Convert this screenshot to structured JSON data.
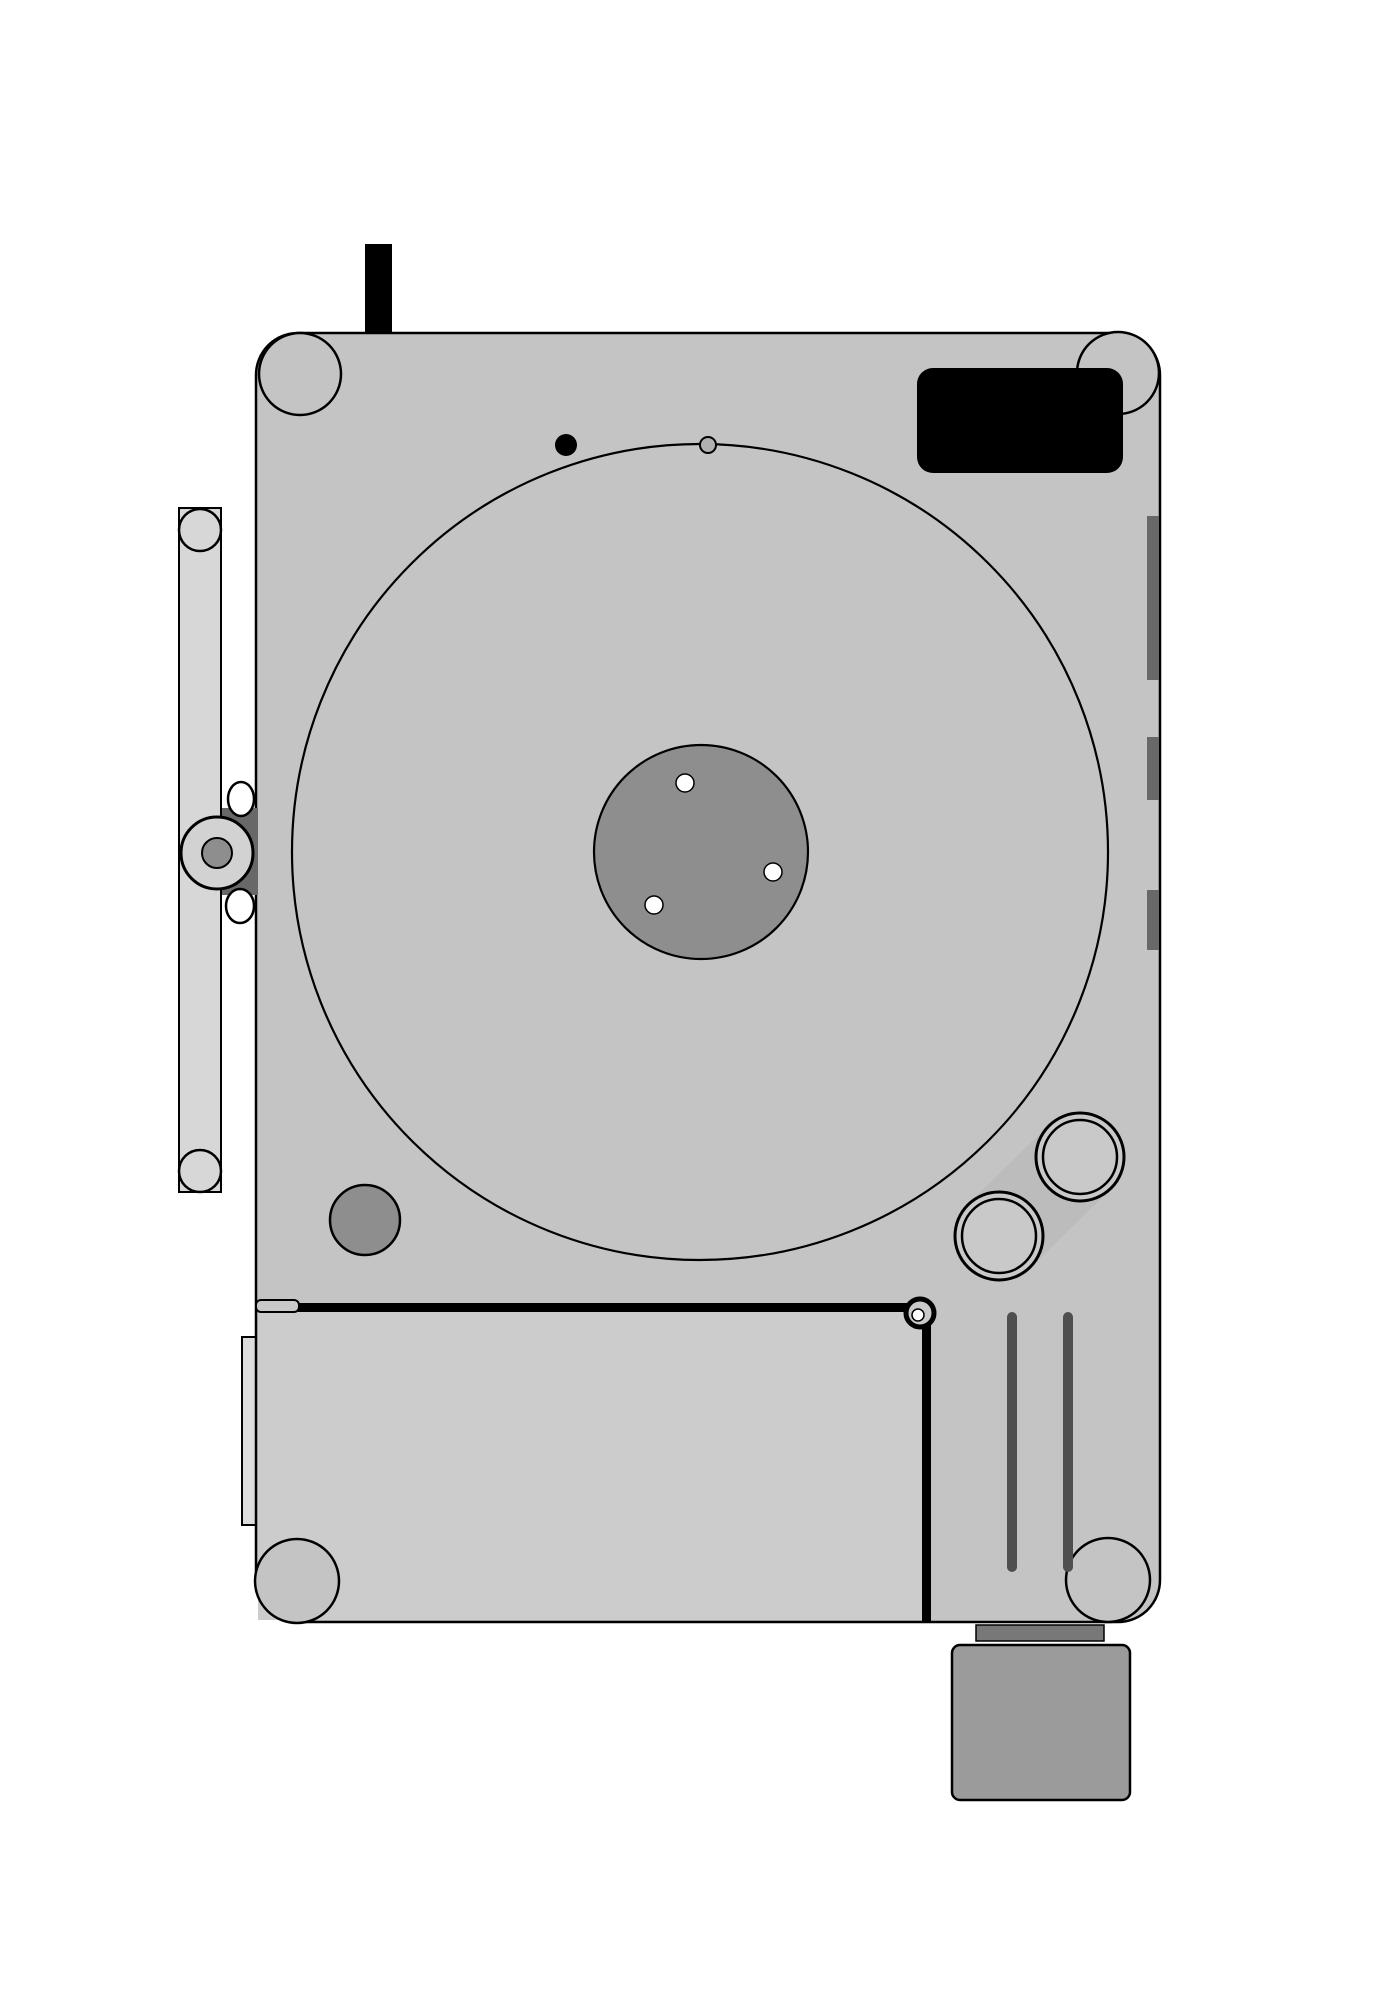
{
  "canvas": {
    "width": 1400,
    "height": 2004,
    "background": "#ffffff",
    "ink": "#000000"
  },
  "colors": {
    "body": "#c4c4c4",
    "board": "#cccccc",
    "rail": "#d7d7d7",
    "notch": "#dcdcdc",
    "pivot": "#d2d2d2",
    "mid": "#8e8e8e",
    "dark": "#686868",
    "strip": "#4f4f4f",
    "motor": "#9b9b9b",
    "motorbar": "#787878",
    "capsule": "#bcbcbc",
    "ringfill": "#c9c9c9",
    "graydot": "#b0b0b0",
    "black": "#000000",
    "white": "#ffffff"
  },
  "drawing": {
    "under_shapes": [
      {
        "t": "rect",
        "name": "side-notch",
        "x": 242,
        "y": 1337,
        "w": 17,
        "h": 188,
        "f": "notch",
        "sc": "black",
        "s": 2
      },
      {
        "t": "rect",
        "name": "plinth-body",
        "x": 256,
        "y": 333,
        "w": 904,
        "h": 1289,
        "rx": 42,
        "f": "body",
        "sc": "black",
        "s": 2.5
      },
      {
        "t": "rect",
        "name": "lower-left-board",
        "x": 258,
        "y": 1312,
        "w": 664,
        "h": 308,
        "f": "board"
      },
      {
        "t": "circle",
        "name": "corner-post-top-left",
        "cx": 300,
        "cy": 374,
        "r": 41,
        "f": "body",
        "sc": "black",
        "s": 2.5
      },
      {
        "t": "circle",
        "name": "corner-post-top-right",
        "cx": 1118,
        "cy": 373,
        "r": 41,
        "f": "body",
        "sc": "black",
        "s": 2.5
      },
      {
        "t": "circle",
        "name": "corner-post-bottom-left",
        "cx": 297,
        "cy": 1581,
        "r": 42,
        "f": "body",
        "sc": "black",
        "s": 2.5
      },
      {
        "t": "circle",
        "name": "corner-post-bottom-right",
        "cx": 1108,
        "cy": 1580,
        "r": 42,
        "f": "body",
        "sc": "black",
        "s": 2.5
      },
      {
        "t": "rect",
        "name": "hinge-rail",
        "x": 179,
        "y": 508,
        "w": 42,
        "h": 684,
        "f": "rail",
        "sc": "black",
        "s": 2
      },
      {
        "t": "circle",
        "name": "hinge-knob-top",
        "cx": 200,
        "cy": 530,
        "r": 21,
        "f": "rail",
        "sc": "black",
        "s": 2.5
      },
      {
        "t": "circle",
        "name": "hinge-knob-bottom",
        "cx": 200,
        "cy": 1171,
        "r": 21,
        "f": "rail",
        "sc": "black",
        "s": 2.5
      },
      {
        "t": "rect",
        "name": "pivot-cam-wedge",
        "x": 222,
        "y": 808,
        "w": 36,
        "h": 87,
        "f": "dark"
      },
      {
        "t": "circle",
        "name": "lid-pivot-outer",
        "cx": 217,
        "cy": 853,
        "r": 36,
        "f": "pivot",
        "sc": "black",
        "s": 3
      },
      {
        "t": "circle",
        "name": "lid-pivot-inner",
        "cx": 217,
        "cy": 853,
        "r": 15,
        "f": "mid",
        "sc": "black",
        "s": 2
      },
      {
        "t": "ellipse",
        "name": "pivot-roller-top",
        "cx": 241,
        "cy": 799,
        "rx": 13,
        "ry": 17,
        "f": "white",
        "sc": "black",
        "s": 2.5
      },
      {
        "t": "ellipse",
        "name": "pivot-roller-bottom",
        "cx": 240,
        "cy": 906,
        "rx": 14,
        "ry": 17,
        "f": "white",
        "sc": "black",
        "s": 2.5
      },
      {
        "t": "circle",
        "name": "platter-outline",
        "cx": 700,
        "cy": 852,
        "r": 408,
        "f": "none",
        "sc": "black",
        "s": 2.2
      },
      {
        "t": "circle",
        "name": "platter-hub",
        "cx": 701,
        "cy": 852,
        "r": 107,
        "f": "mid",
        "sc": "black",
        "s": 2.2
      },
      {
        "t": "circle",
        "name": "hub-hole-1",
        "cx": 685,
        "cy": 783,
        "r": 9,
        "f": "white",
        "sc": "black",
        "s": 1.5
      },
      {
        "t": "circle",
        "name": "hub-hole-2",
        "cx": 773,
        "cy": 872,
        "r": 9,
        "f": "white",
        "sc": "black",
        "s": 1.5
      },
      {
        "t": "circle",
        "name": "hub-hole-3",
        "cx": 654,
        "cy": 905,
        "r": 9,
        "f": "white",
        "sc": "black",
        "s": 1.5
      },
      {
        "t": "circle",
        "name": "power-dot",
        "cx": 566,
        "cy": 445,
        "r": 11,
        "f": "black"
      },
      {
        "t": "circle",
        "name": "pilot-dot",
        "cx": 708,
        "cy": 445,
        "r": 8,
        "f": "graydot",
        "sc": "black",
        "s": 2
      },
      {
        "t": "circle",
        "name": "speed-knob",
        "cx": 365,
        "cy": 1220,
        "r": 35,
        "f": "mid",
        "sc": "black",
        "s": 2.5
      },
      {
        "t": "poly",
        "name": "tonearm-base-capsule",
        "pts": "968,1204 1049,1125 1111,1189 1030,1268",
        "f": "capsule"
      },
      {
        "t": "circle",
        "name": "arm-bearing-upper-outer",
        "cx": 1080,
        "cy": 1157,
        "r": 44,
        "f": "ringfill",
        "sc": "black",
        "s": 3
      },
      {
        "t": "circle",
        "name": "arm-bearing-upper-inner",
        "cx": 1080,
        "cy": 1157,
        "r": 37,
        "f": "none",
        "sc": "black",
        "s": 2.5
      },
      {
        "t": "circle",
        "name": "arm-bearing-lower-outer",
        "cx": 999,
        "cy": 1236,
        "r": 44,
        "f": "ringfill",
        "sc": "black",
        "s": 3
      },
      {
        "t": "circle",
        "name": "arm-bearing-lower-inner",
        "cx": 999,
        "cy": 1236,
        "r": 37,
        "f": "none",
        "sc": "black",
        "s": 2.5
      },
      {
        "t": "rect",
        "name": "control-pad",
        "x": 917,
        "y": 368,
        "w": 206,
        "h": 105,
        "rx": 16,
        "f": "black"
      },
      {
        "t": "rect",
        "name": "edge-mark-1",
        "x": 1147,
        "y": 516,
        "w": 12,
        "h": 164,
        "f": "dark"
      },
      {
        "t": "rect",
        "name": "edge-mark-2",
        "x": 1147,
        "y": 737,
        "w": 12,
        "h": 63,
        "f": "dark"
      },
      {
        "t": "rect",
        "name": "edge-mark-3",
        "x": 1147,
        "y": 890,
        "w": 12,
        "h": 60,
        "f": "dark"
      },
      {
        "t": "rect",
        "name": "motor-collar",
        "x": 976,
        "y": 1625,
        "w": 128,
        "h": 16,
        "f": "motorbar",
        "sc": "black",
        "s": 1.5
      },
      {
        "t": "rect",
        "name": "motor-block",
        "x": 952,
        "y": 1645,
        "w": 178,
        "h": 155,
        "rx": 8,
        "f": "motor",
        "sc": "black",
        "s": 2.5
      }
    ],
    "hlines": [
      [
        333,
        0,
        1400,
        2.5
      ],
      [
        366,
        0,
        1400,
        2
      ],
      [
        443,
        0,
        1400,
        2
      ],
      [
        475,
        0,
        1400,
        2
      ],
      [
        503,
        0,
        1400,
        1.8
      ],
      [
        511,
        0,
        1400,
        1.8
      ],
      [
        680,
        0,
        1400,
        2
      ],
      [
        688,
        0,
        1400,
        2
      ],
      [
        735,
        0,
        1400,
        2
      ],
      [
        742,
        0,
        1400,
        1.6
      ],
      [
        808,
        0,
        1400,
        2
      ],
      [
        890,
        0,
        1400,
        2
      ],
      [
        897,
        0,
        1400,
        1.6
      ],
      [
        960,
        0,
        1400,
        2
      ],
      [
        966,
        0,
        1400,
        1.6
      ],
      [
        1192,
        0,
        1400,
        2.5
      ],
      [
        1263,
        0,
        1400,
        2
      ],
      [
        1292,
        0,
        1400,
        1.8
      ],
      [
        1298,
        0,
        1400,
        1.8
      ],
      [
        1307,
        0,
        1400,
        1.6
      ],
      [
        1338,
        500,
        1400,
        1.8
      ],
      [
        1347,
        500,
        1400,
        1.8
      ],
      [
        1622,
        0,
        1400,
        2.5
      ],
      [
        1642,
        0,
        1400,
        1.8
      ],
      [
        1648,
        0,
        1400,
        1.8
      ],
      [
        1800,
        690,
        1400,
        2
      ],
      [
        1806,
        690,
        1400,
        2
      ]
    ],
    "vlines": [
      [
        141,
        330,
        1195,
        1.8
      ],
      [
        178,
        0,
        2004,
        2
      ],
      [
        221,
        0,
        2004,
        2
      ],
      [
        258,
        0,
        2004,
        1.8
      ],
      [
        367,
        0,
        2004,
        2
      ],
      [
        394,
        0,
        2004,
        2
      ],
      [
        484,
        0,
        2004,
        2
      ],
      [
        700,
        0,
        2004,
        2
      ],
      [
        927,
        1622,
        2004,
        1.8
      ],
      [
        937,
        66,
        2004,
        1.8
      ],
      [
        945,
        66,
        2004,
        1.8
      ],
      [
        1008,
        66,
        2004,
        1.8
      ],
      [
        1017,
        66,
        2004,
        1.8
      ],
      [
        1063,
        66,
        2004,
        1.8
      ],
      [
        1072,
        66,
        2004,
        1.8
      ],
      [
        1128,
        66,
        1806,
        1.8
      ],
      [
        1137,
        66,
        1806,
        1.8
      ],
      [
        1149,
        66,
        1622,
        1.8
      ],
      [
        1160,
        0,
        2004,
        2.2
      ],
      [
        1172,
        66,
        2004,
        1.8
      ]
    ],
    "diagonals": [
      {
        "name": "platter-tangent-diagonal",
        "x1": 927,
        "y1": 1200,
        "x2": 1072,
        "y2": 1055,
        "w": 2
      },
      {
        "name": "capsule-tangent-upper",
        "x1": 940,
        "y1": 1232,
        "x2": 1085,
        "y2": 1087,
        "w": 2.5
      },
      {
        "name": "capsule-tangent-lower",
        "x1": 1030,
        "y1": 1268,
        "x2": 1111,
        "y2": 1189,
        "w": 2.5
      }
    ],
    "over_shapes": [
      {
        "t": "rect",
        "name": "belt-strip-left",
        "x": 1007,
        "y": 1312,
        "w": 10,
        "h": 260,
        "rx": 5,
        "f": "strip"
      },
      {
        "t": "rect",
        "name": "belt-strip-right",
        "x": 1063,
        "y": 1312,
        "w": 10,
        "h": 260,
        "rx": 5,
        "f": "strip"
      },
      {
        "t": "rect",
        "name": "tonearm-counterweight",
        "x": 256,
        "y": 1300,
        "w": 43,
        "h": 12,
        "rx": 5,
        "f": "ringfill",
        "sc": "black",
        "s": 2
      },
      {
        "t": "rect",
        "name": "tonearm-tube",
        "x": 298,
        "y": 1303,
        "w": 622,
        "h": 9,
        "f": "black"
      },
      {
        "t": "rect",
        "name": "board-divider-bar",
        "x": 922,
        "y": 1313,
        "w": 9,
        "h": 309,
        "f": "black"
      },
      {
        "t": "circle",
        "name": "tonearm-pivot-ring",
        "cx": 920,
        "cy": 1313,
        "r": 14,
        "f": "ringfill",
        "sc": "black",
        "s": 5
      },
      {
        "t": "circle",
        "name": "tonearm-pivot-hole",
        "cx": 918,
        "cy": 1315,
        "r": 6,
        "f": "white",
        "sc": "black",
        "s": 1.5
      },
      {
        "t": "rect",
        "name": "rear-tab",
        "x": 365,
        "y": 244,
        "w": 27,
        "h": 89,
        "f": "black"
      }
    ]
  }
}
